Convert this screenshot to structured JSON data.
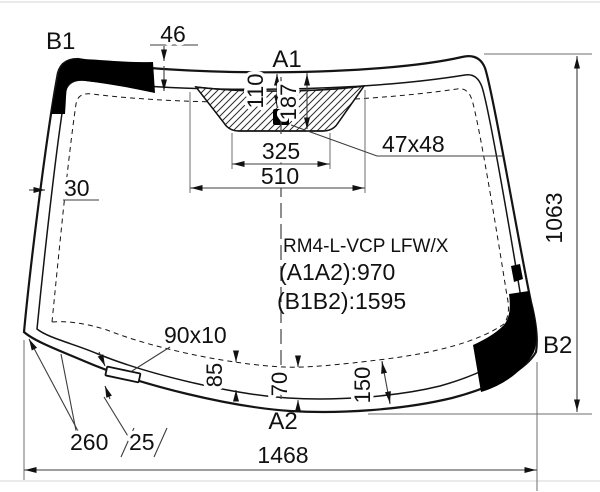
{
  "part": {
    "code": "RM4-L-VCP LFW/X",
    "a1a2": "(A1A2):970",
    "b1b2": "(B1B2):1595"
  },
  "corners": {
    "b1": "B1",
    "a1": "A1",
    "b2": "B2",
    "a2": "A2"
  },
  "dims": {
    "top_band": "46",
    "side_moulding": "30",
    "sensor_offset": "110",
    "pad_depth": "187",
    "pad_inner_width": "325",
    "pad_outer_width": "510",
    "sensor_window": "47x48",
    "glass_height": "1063",
    "frit_85": "85",
    "frit_70": "70",
    "frit_150": "150",
    "slot_size": "90x10",
    "slot_from_corner": "260",
    "slot_offset": "25",
    "glass_width": "1468"
  },
  "colors": {
    "line": "#141414",
    "dim_line": "#3d3d3d",
    "frit_dash": "#777777",
    "black_band": "#000000"
  }
}
